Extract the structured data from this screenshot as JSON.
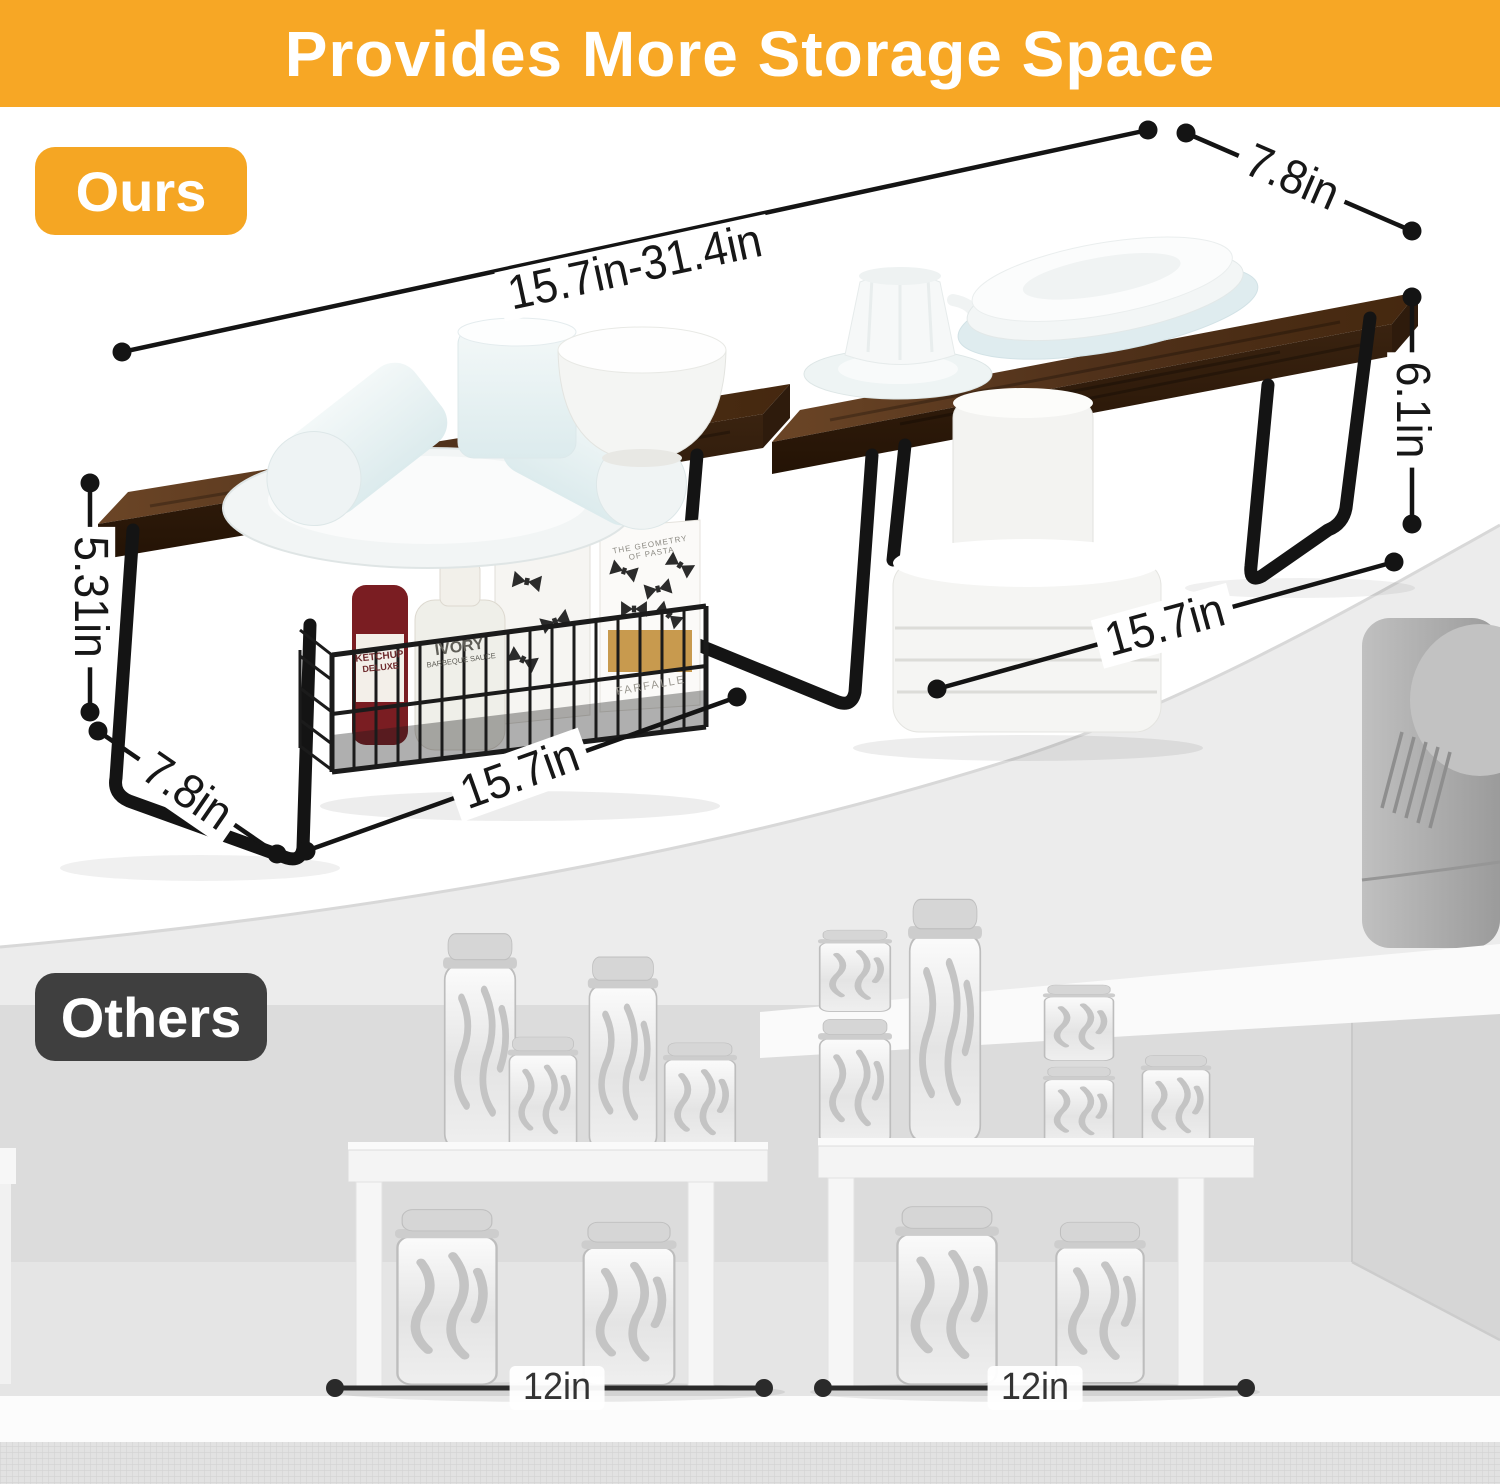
{
  "banner": {
    "title": "Provides More Storage Space"
  },
  "theme": {
    "banner_bg": "#F7A725",
    "ours_badge_bg": "#F5A623",
    "others_badge_bg": "#3F3F3F",
    "dimension_text_color": "#171717",
    "wood_color": "#4a2d16",
    "metal_leg_color": "#141414"
  },
  "ours": {
    "badge_label": "Ours",
    "dimensions": {
      "top_span": "15.7in-31.4in",
      "top_depth": "7.8in",
      "right_height": "6.1in",
      "left_height": "5.31in",
      "bottom_left_depth": "7.8in",
      "bottom_board_width": "15.7in",
      "right_board_width": "15.7in"
    },
    "basket_items": {
      "ketchup_line1": "KETCHUP",
      "ketchup_line2": "DELUXE",
      "sauce_line1": "IVORY",
      "sauce_line2": "BARBEQUE SAUCE",
      "pasta_box_line1": "THE GEOMETRY",
      "pasta_box_line2": "OF PASTA",
      "pasta_name": "FARFALLE"
    }
  },
  "others": {
    "badge_label": "Others",
    "dimensions": {
      "left_shelf_width": "12in",
      "right_shelf_width": "12in"
    }
  }
}
